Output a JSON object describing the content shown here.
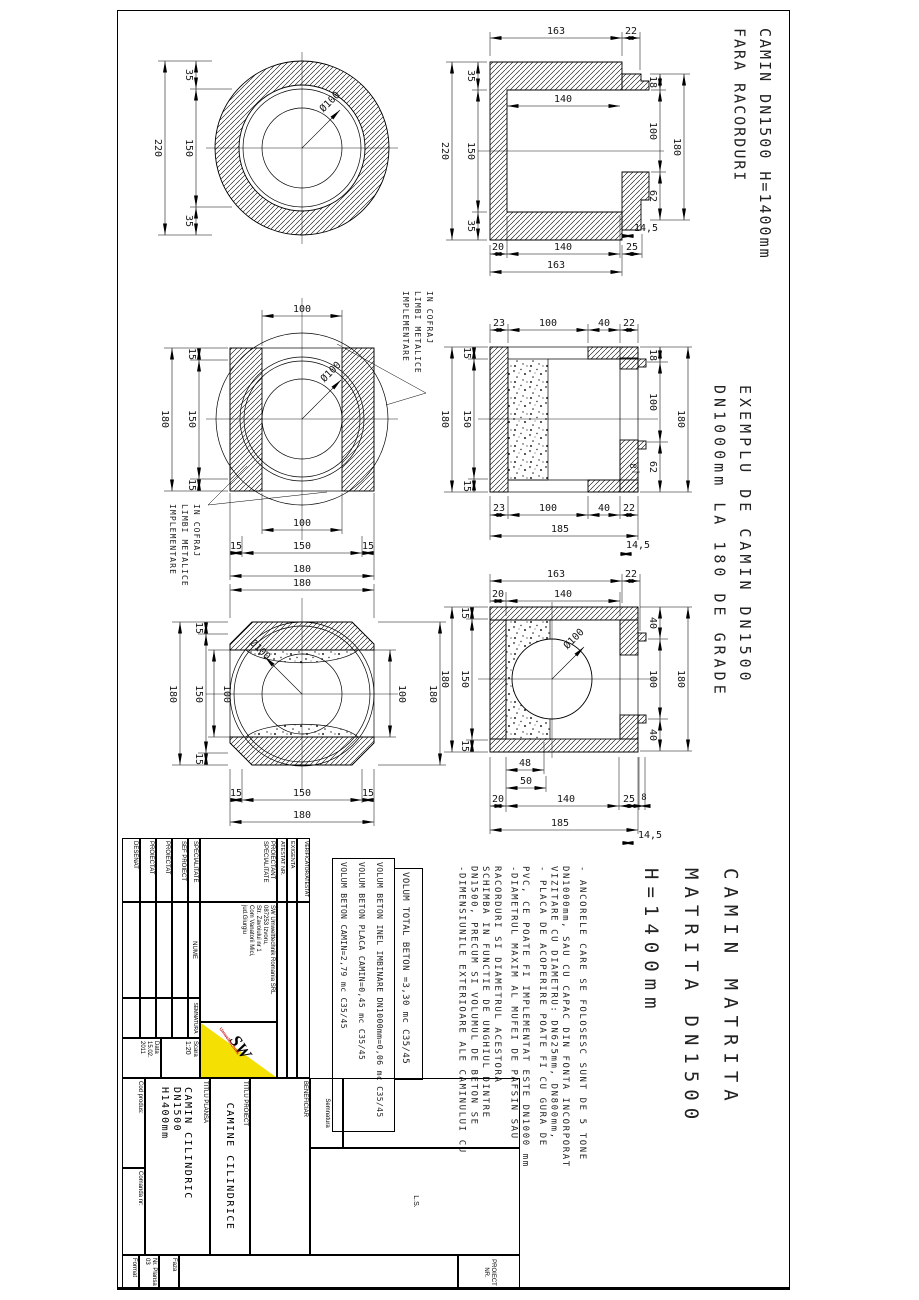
{
  "page": {
    "background": "#ffffff",
    "line_color": "#000000",
    "logo_yellow": "#f5e003",
    "logo_red": "#cc2222"
  },
  "titles": {
    "t1_line1": "CAMIN DN1500 H=1400mm",
    "t1_line2": "FARA RACORDURI",
    "t2_line1": "EXEMPLU DE CAMIN DN1500",
    "t2_line2": "DN1000mm LA 180 DE GRADE",
    "t3_line1": "CAMIN MATRITA",
    "t3_line2": "MATRITA DN1500",
    "t3_line3": "H=1400mm"
  },
  "callout": {
    "line1": "IMPLEMENTARE",
    "line2": "LIMBI METALICE",
    "line3": "IN COFRAJ"
  },
  "notes": {
    "n1": [
      "-DIMENSIUNILE EXTERIOARE ALE CAMINULUI CU",
      "DN1500, PRECUM SI VOLUMUL DE BETON SE",
      "SCHIMBA IN FUNCTIE DE UNGHIUL DINTRE",
      "RACORDURI SI DIAMETRUL ACESTORA"
    ],
    "n2": [
      "-DIAMETRUL MAXIM AL MUFEI DE PAFSIN SAU",
      "PVC, CE POATE FI IMPLEMENTAT ESTE DN1000 mm"
    ],
    "n3": [
      "- PLACA DE ACOPERIRE POATE FI CU GURA DE",
      "VIZITARE CU DIAMETRU: DN625mm, DN800mm,",
      "DN1000mm, SAU CU CAPAC DIN FONTA INCORPORAT"
    ],
    "n4": [
      "- ANCORELE CARE SE FOLOSESC SUNT DE 5 TONE"
    ]
  },
  "volumes": {
    "v1": "VOLUM BETON CAMIN=2,79 mc C35/45",
    "v2": "VOLUM BETON PLACA CAMIN=0,45 mc C35/45",
    "v3": "VOLUM BETON INEL IMBINARE DN1000mm=0,06 mc C35/45",
    "total": "VOLUM TOTAL BETON =3,30 mc C35/45"
  },
  "dims": {
    "d8": "8",
    "d14_5": "14,5",
    "d15": "15",
    "d18": "18",
    "d20": "20",
    "d22": "22",
    "d23": "23",
    "d25": "25",
    "d35": "35",
    "d40": "40",
    "d48": "48",
    "d50": "50",
    "d62": "62",
    "d100": "100",
    "d140": "140",
    "d150": "150",
    "d163": "163",
    "d180": "180",
    "d185": "185",
    "d220": "220",
    "dia100": "Ø100"
  },
  "titleblock": {
    "verificator1": "VERIFICATOR",
    "verificator2": "ATESTAT",
    "exigenta": "EXIGENTA",
    "atestat_nr": "ATESTAT NR.",
    "proiectant": "PROIECTAN'T'",
    "proiectant_l1": "PROIECTANT",
    "proiectant_l2": "SPECIALITATE",
    "company1": "SW Umwelttechnik Romania SRL",
    "company2": "087253 Izvoru,",
    "company3": "Str. Zavoiului nr 1",
    "company4": "Com Vanatorii Mici,",
    "company5": "jud.Giurgiu",
    "specialitate": "SPECIALITATE",
    "nume": "NUME",
    "semnatura_col": "SEMNATURA",
    "sef_proiect": "SEF PROIECT",
    "proiectat1": "PROIECTAT",
    "proiectat2": "PROIECTAT",
    "desenat": "DESENAT",
    "scara_label": "Scara",
    "scara": "1:20",
    "data_label": "Data",
    "data1": "15.02.",
    "data2": "2011",
    "semnatura": "Semnatura",
    "beneficiar": "BENEFICIAR",
    "ls": "L.S.",
    "proiect_nr": "PROIECT NR.",
    "titlu_proiect_label": "TITLU PROIECT",
    "titlu_proiect": "CAMINE CILINDRICE",
    "titlu_plansa_label": "TITLU PLANSA",
    "titlu_plansa1": "CAMIN CILINDRIC DN1500",
    "titlu_plansa2": "H1400mm",
    "cod_produs": "Cod produs:",
    "comanda": "Comanda nr:",
    "faza": "Faza",
    "nr_plansa": "Nr. Plansa",
    "nr_plansa_val": "03",
    "format": "Format",
    "logo_sw": "SW",
    "logo_sub": "Umwelttechnik"
  }
}
